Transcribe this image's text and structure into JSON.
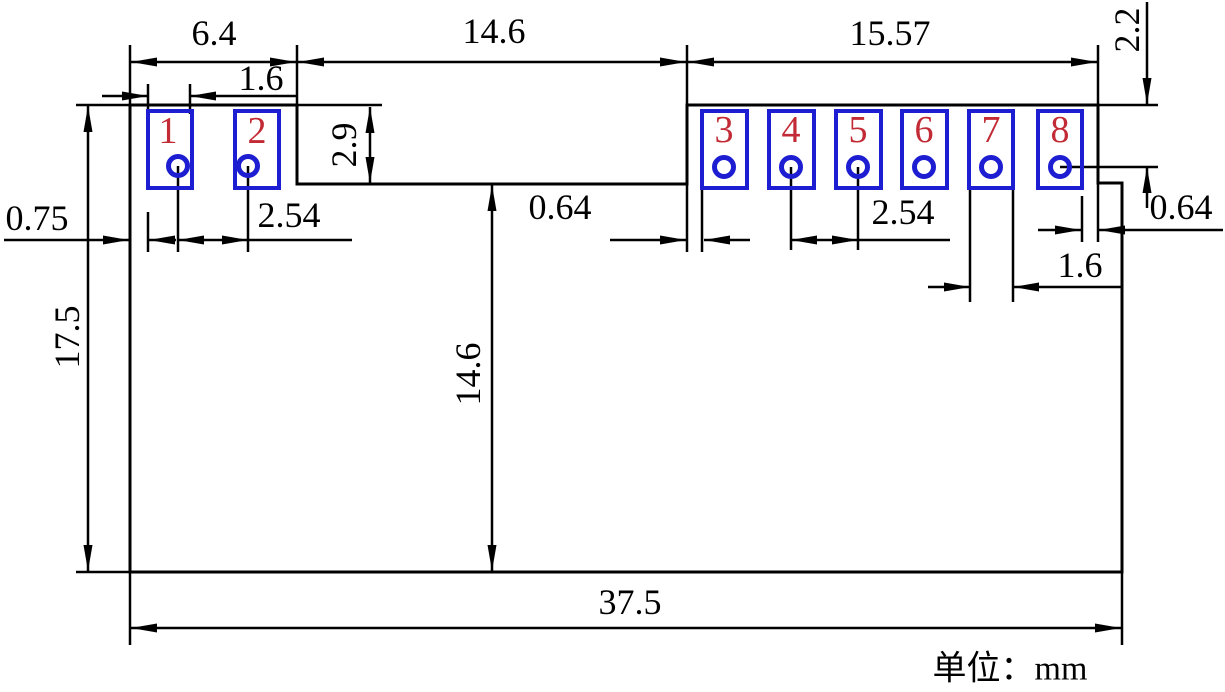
{
  "unit_label": "单位：mm",
  "colors": {
    "line": "#000000",
    "pad_outline": "#1d1dd1",
    "pad_number": "#c22b35",
    "background": "#ffffff"
  },
  "pads": [
    {
      "number": "1"
    },
    {
      "number": "2"
    },
    {
      "number": "3"
    },
    {
      "number": "4"
    },
    {
      "number": "5"
    },
    {
      "number": "6"
    },
    {
      "number": "7"
    },
    {
      "number": "8"
    }
  ],
  "dimensions": {
    "left_section_width": "6.4",
    "notch_width": "14.6",
    "right_section_width": "15.57",
    "pad1_width": "1.6",
    "left_edge_to_pad1": "0.75",
    "left_pad_pitch": "2.54",
    "notch_to_pad3": "0.64",
    "right_pad_pitch": "2.54",
    "pad7_width": "1.6",
    "pad8_to_right_edge": "0.64",
    "top_edge_to_hole": "2.2",
    "notch_depth": "2.9",
    "overall_height": "17.5",
    "notch_to_bottom_height": "14.6",
    "overall_width": "37.5"
  }
}
